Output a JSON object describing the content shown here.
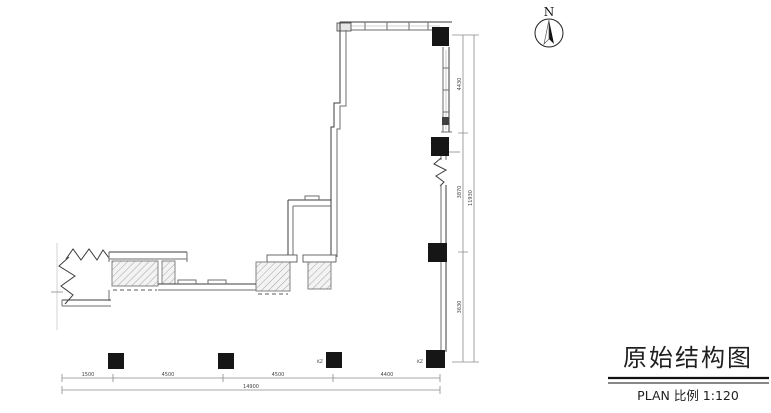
{
  "sheet": {
    "title": "原始结构图",
    "scale_label": "PLAN 比例  1:120"
  },
  "compass": {
    "north_label": "N"
  },
  "dimensions": {
    "right": {
      "segments": [
        "4430",
        "3870",
        "3630"
      ],
      "total": "11930"
    },
    "bottom": {
      "segments": [
        "1500",
        "4500",
        "4500",
        "4400"
      ],
      "total": "14900"
    }
  },
  "columns": {
    "tag": "KZ"
  },
  "colors": {
    "background": "#ffffff",
    "line": "#3c3c3c",
    "wall": "#6e6e6e",
    "column_fill": "#161616",
    "hatch": "#9a9a9a"
  }
}
